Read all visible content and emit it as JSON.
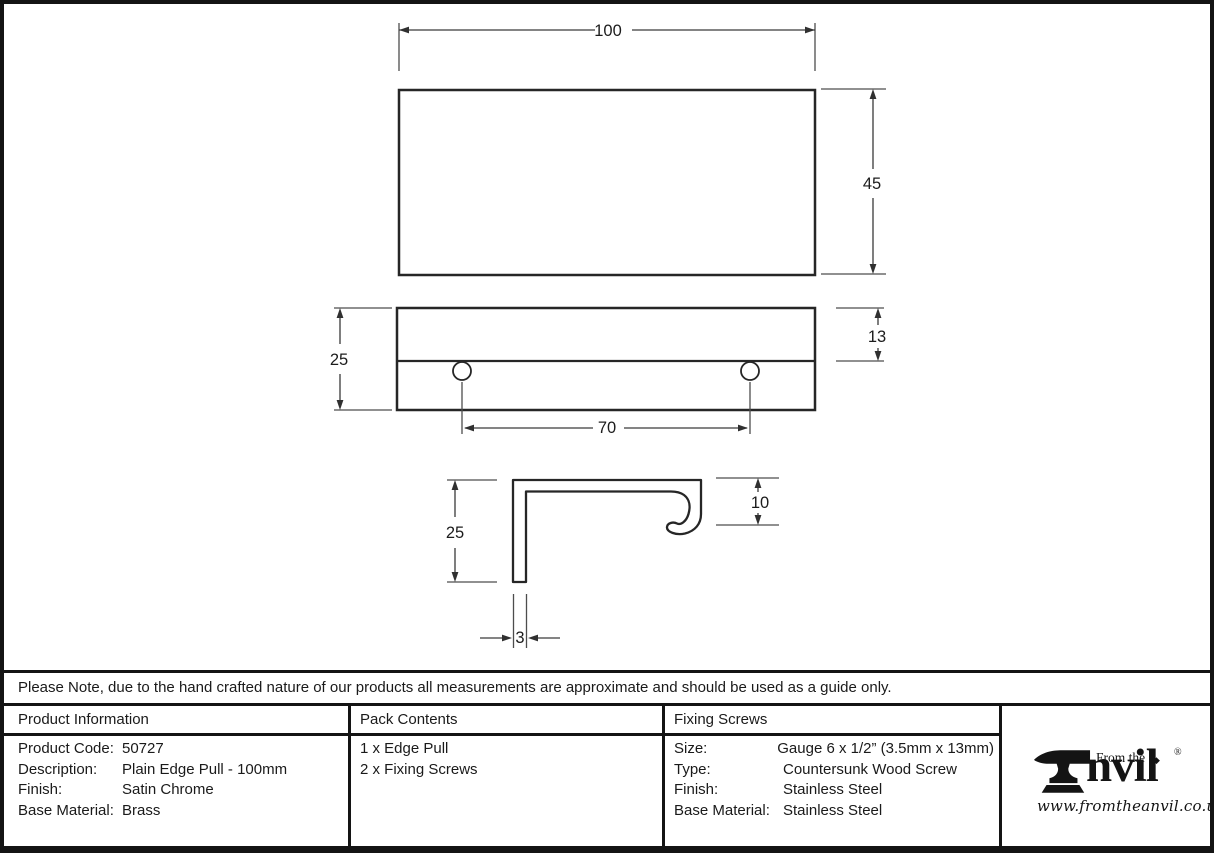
{
  "note": "Please Note, due to the hand crafted nature of our products all measurements are approximate and should be used as a guide only.",
  "drawing": {
    "front_view": {
      "width": "100",
      "height": "45"
    },
    "side_view": {
      "height": "25",
      "plate_offset": "13",
      "hole_spacing": "70"
    },
    "profile_view": {
      "depth": "25",
      "lip": "10",
      "thickness": "3"
    }
  },
  "product_information": {
    "header": "Product Information",
    "rows": [
      {
        "label": "Product Code:",
        "value": "50727"
      },
      {
        "label": "Description:",
        "value": "Plain Edge Pull - 100mm"
      },
      {
        "label": "Finish:",
        "value": "Satin Chrome"
      },
      {
        "label": "Base Material:",
        "value": "Brass"
      }
    ]
  },
  "pack_contents": {
    "header": "Pack Contents",
    "items": [
      "1 x Edge Pull",
      "2 x Fixing Screws"
    ]
  },
  "fixing_screws": {
    "header": "Fixing Screws",
    "rows": [
      {
        "label": "Size:",
        "value": "Gauge 6 x 1/2” (3.5mm x 13mm)"
      },
      {
        "label": "Type:",
        "value": "Countersunk Wood Screw"
      },
      {
        "label": "Finish:",
        "value": "Stainless Steel"
      },
      {
        "label": "Base Material:",
        "value": "Brass"
      }
    ]
  },
  "fixing_screws_values": {
    "base_material": "Stainless Steel",
    "finish": "Stainless Steel"
  },
  "logo": {
    "brand_prefix": "From the",
    "brand_name": "nvil",
    "diamond": "◆",
    "registered": "®",
    "website": "www.fromtheanvil.co.uk"
  },
  "colors": {
    "ink": "#141414",
    "outline": "#262626",
    "dim_line": "#4d4d4d",
    "background": "#ffffff"
  }
}
